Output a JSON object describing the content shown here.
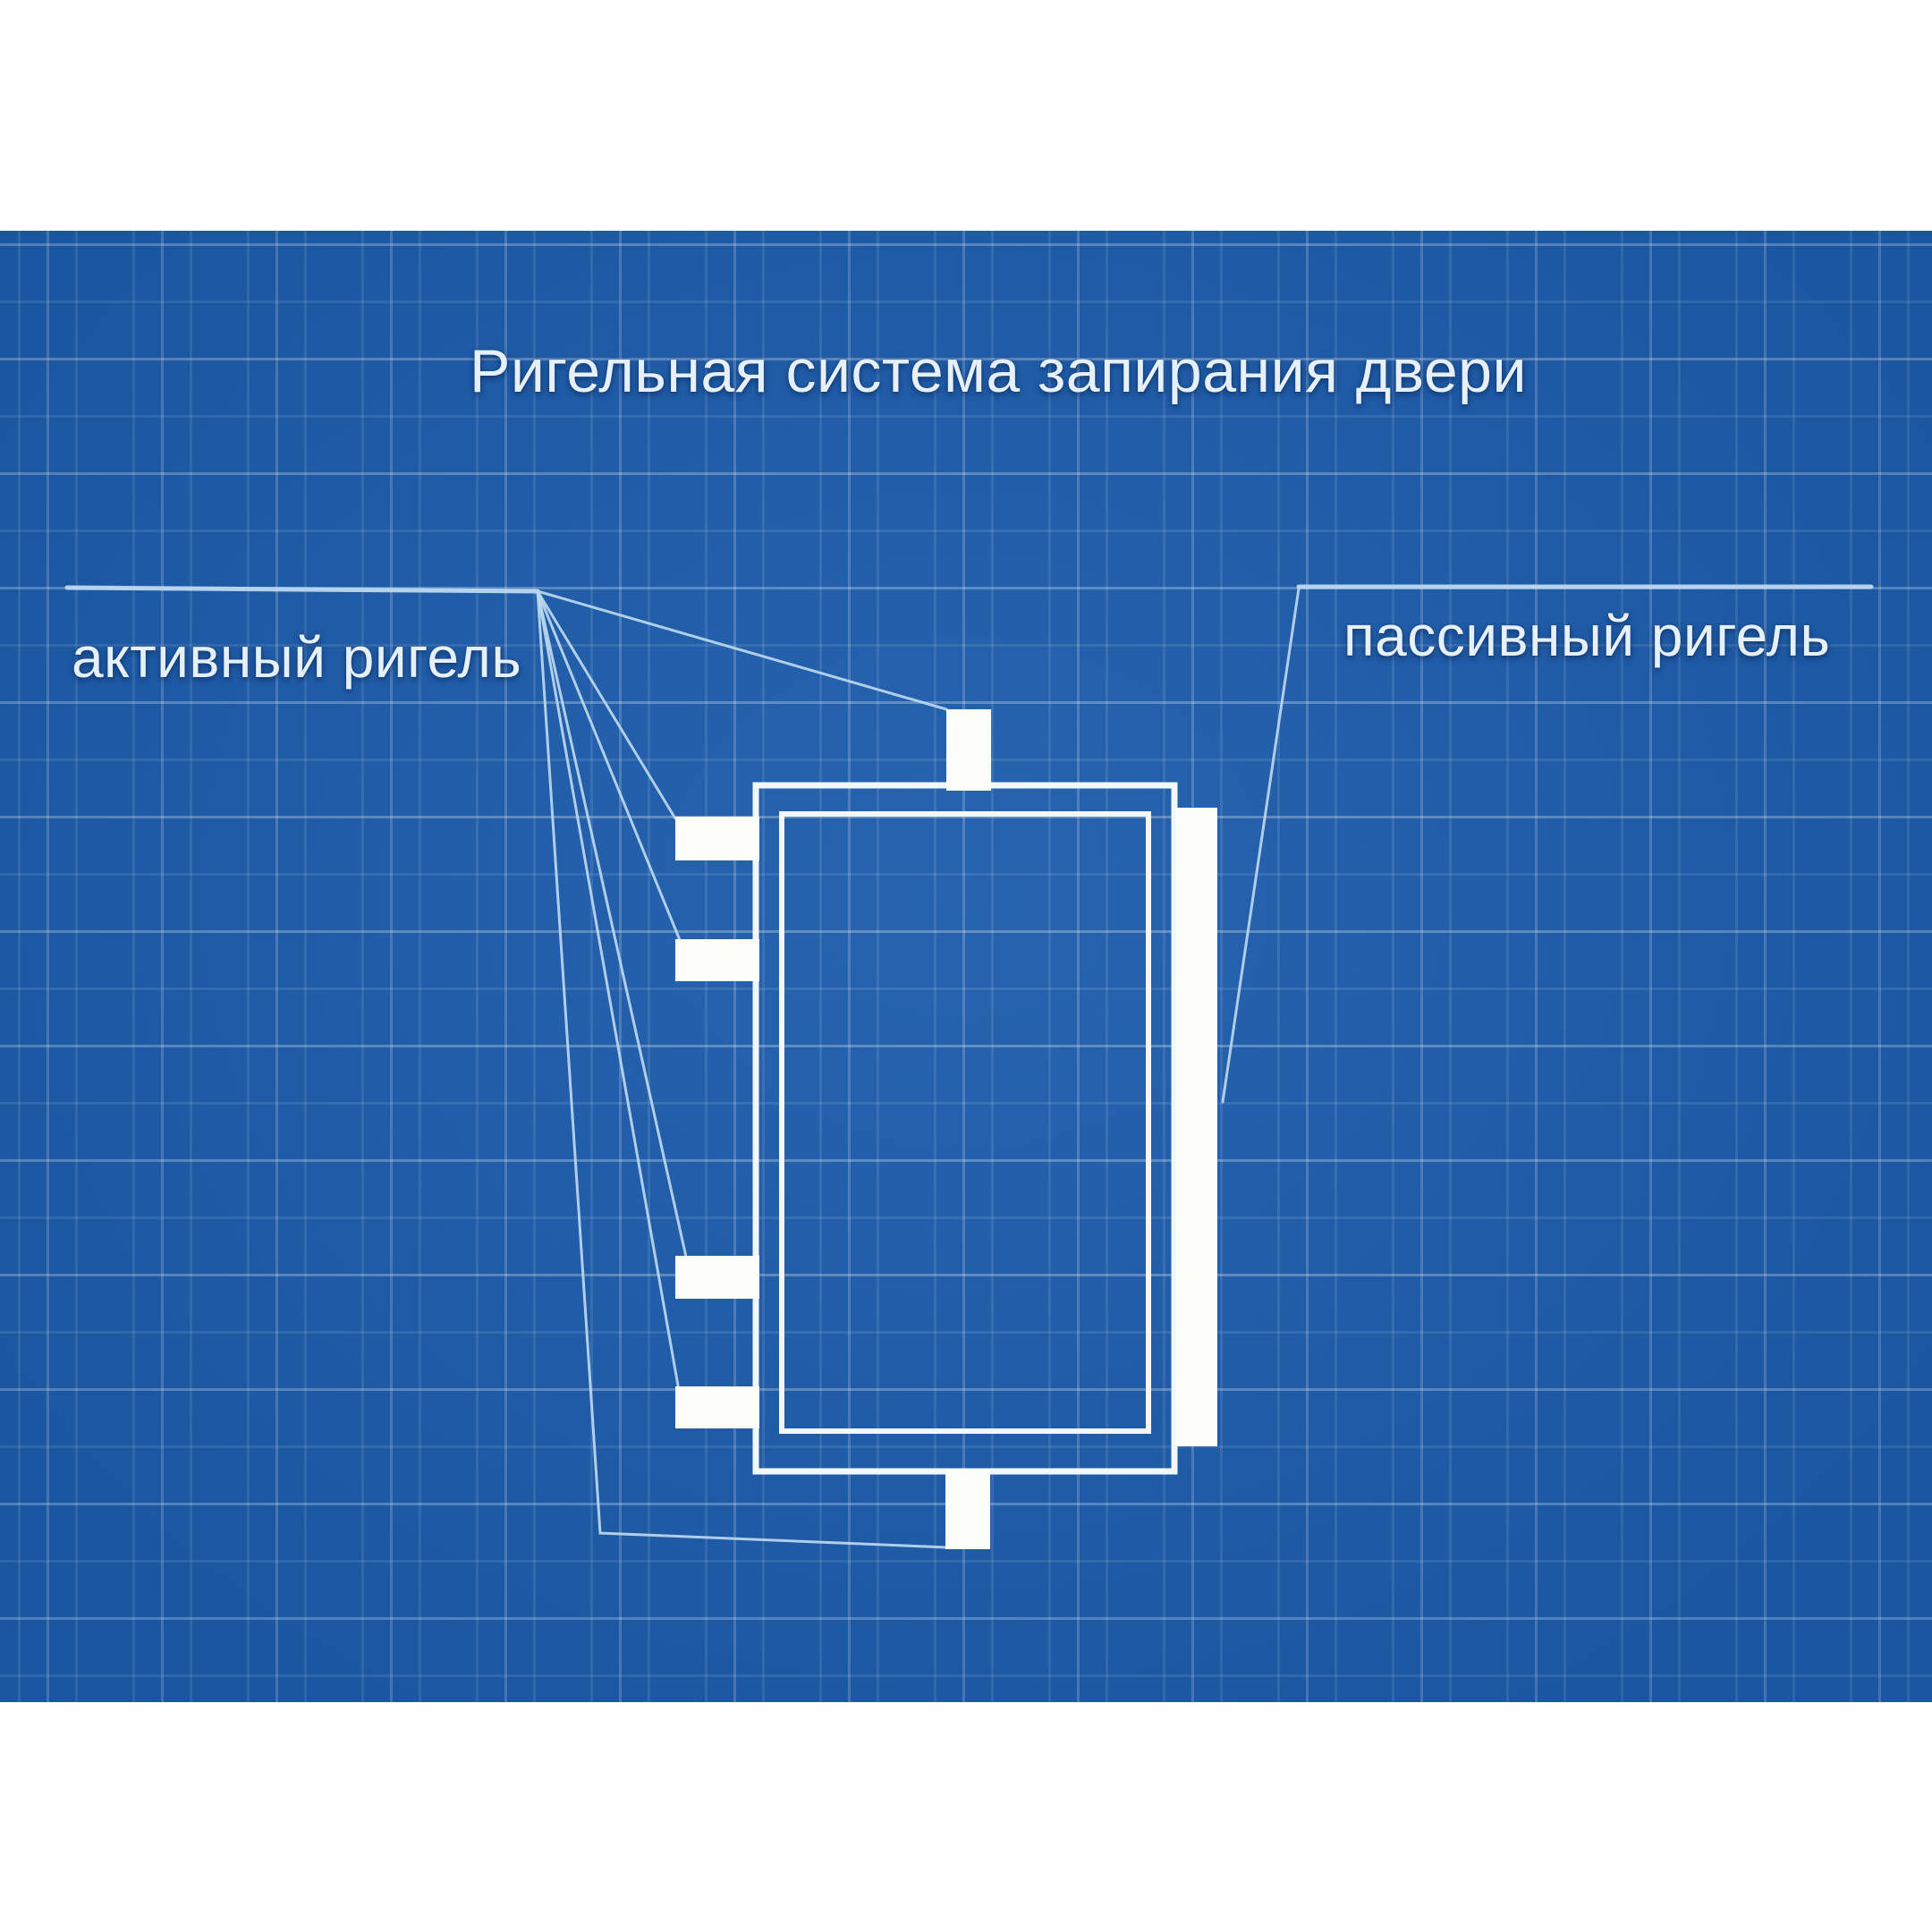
{
  "title": "Ригельная система запирания двери",
  "labels": {
    "active_bolt": "активный ригель",
    "passive_bolt": "пассивный ригель"
  },
  "colors": {
    "blueprint_blue": "#1e5dab",
    "page_margin": "#ffffff",
    "ink": "#e6f0fb",
    "leader_line": "#bcd8ef",
    "outline_white": "#f2f7fc",
    "bolt_white": "#fdfdfa"
  }
}
